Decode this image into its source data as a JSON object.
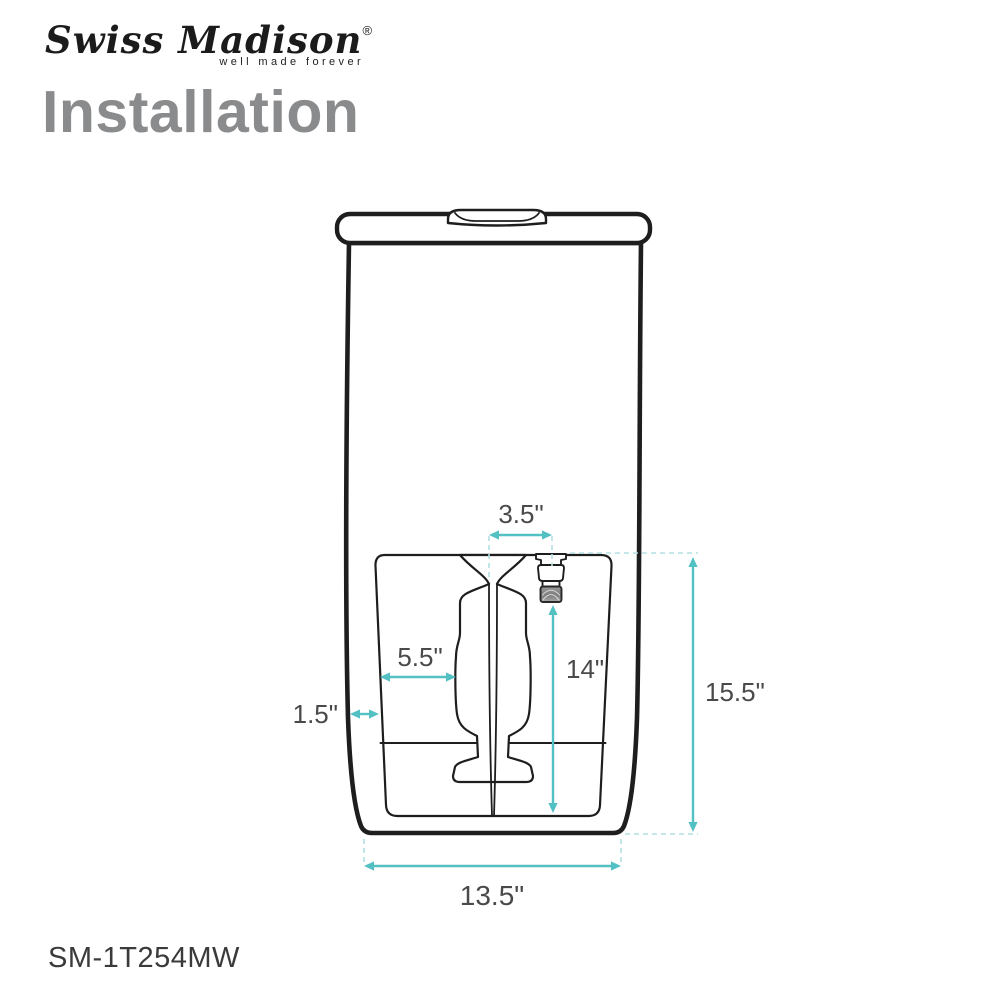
{
  "logo": {
    "brand": "Swiss Madison",
    "registered": "®",
    "tagline": "well made forever"
  },
  "title": "Installation",
  "model_number": "SM-1T254MW",
  "diagram": {
    "description": "One-piece toilet, rear installation view with dimension callouts",
    "dimensions": {
      "supply_offset_top": "3.5\"",
      "trapway_offset": "5.5\"",
      "supply_height": "14\"",
      "side_inset": "1.5\"",
      "overall_height": "15.5\"",
      "base_width": "13.5\""
    }
  },
  "colors": {
    "accent_teal": "#53C0C4",
    "guide_teal": "#B3E0E1",
    "line_black": "#1E1E1E",
    "label_gray": "#4A4A4C",
    "title_gray": "#8A8B8D"
  }
}
